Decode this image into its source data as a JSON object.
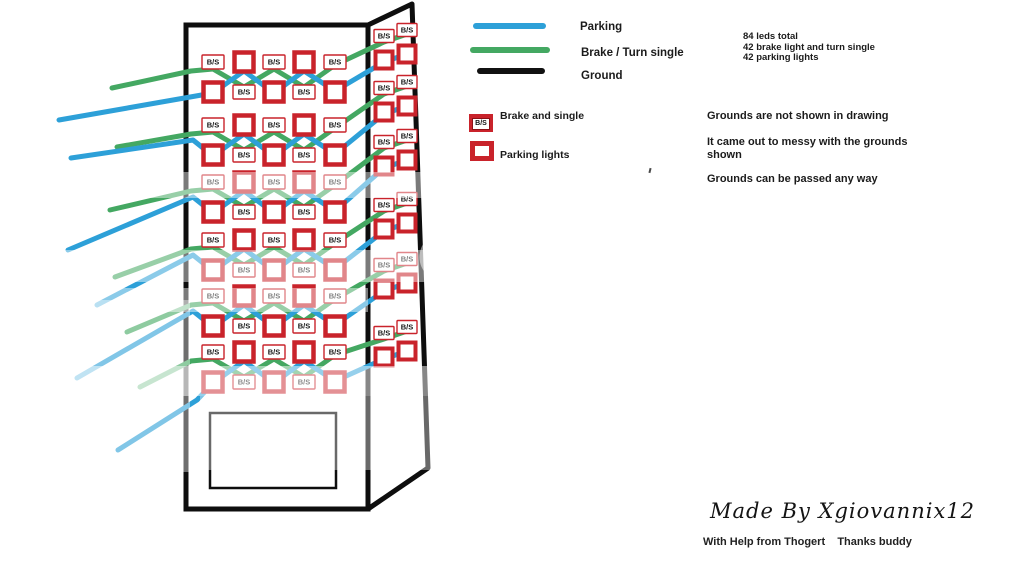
{
  "legend": {
    "lines": [
      {
        "label": "Parking",
        "color": "#2da0d8"
      },
      {
        "label": "Brake / Turn single",
        "color": "#44a862"
      },
      {
        "label": "Ground",
        "color": "#111111"
      }
    ],
    "items": [
      {
        "label": "Brake and single"
      },
      {
        "label": "Parking lights"
      }
    ]
  },
  "stats": [
    "84 leds total",
    "42 brake light and turn single",
    "42 parking lights"
  ],
  "notes": [
    "Grounds are not shown in drawing",
    "It came out to messy with the grounds",
    "shown",
    "Grounds can be passed any way"
  ],
  "credits": {
    "made_by": "Made By Xgiovannix12",
    "help": "With Help from Thogert    Thanks buddy"
  },
  "led_label": "B/S",
  "colors": {
    "wire_parking_blue": "#2da0d8",
    "wire_brake_green": "#44a862",
    "led_red": "#c9232b",
    "outline_black": "#0e0e0e"
  },
  "diagram": {
    "front_cols_x": [
      213,
      244,
      274,
      304,
      335
    ],
    "side_cols_x": [
      384,
      407
    ],
    "row_a_pattern": [
      "bs",
      "p",
      "bs",
      "p",
      "bs"
    ],
    "row_b_pattern": [
      "p",
      "bs",
      "p",
      "bs",
      "p"
    ],
    "groups": [
      {
        "row_a_y": 62,
        "row_b_y": 92,
        "side_y": 36,
        "green_tail": [
          112,
          88
        ],
        "blue_tail": [
          59,
          120
        ],
        "blue_entry": null
      },
      {
        "row_a_y": 125,
        "row_b_y": 155,
        "side_y": 88,
        "green_tail": [
          117,
          147
        ],
        "blue_tail": [
          71,
          158
        ],
        "blue_entry": [
          193,
          140
        ]
      },
      {
        "row_a_y": 182,
        "row_b_y": 212,
        "side_y": 142,
        "green_tail": [
          110,
          210
        ],
        "blue_tail": [
          68,
          250
        ],
        "blue_entry": [
          193,
          197
        ]
      },
      {
        "row_a_y": 240,
        "row_b_y": 270,
        "side_y": 205,
        "green_tail": [
          115,
          277
        ],
        "blue_tail": [
          97,
          305
        ],
        "blue_entry": [
          193,
          255
        ]
      },
      {
        "row_a_y": 296,
        "row_b_y": 326,
        "side_y": 265,
        "green_tail": [
          127,
          332
        ],
        "blue_tail": [
          77,
          378
        ],
        "blue_entry": [
          193,
          311
        ]
      },
      {
        "row_a_y": 352,
        "row_b_y": 382,
        "side_y": 333,
        "green_tail": [
          140,
          387
        ],
        "blue_tail": [
          118,
          450
        ],
        "blue_entry": [
          197,
          400
        ]
      }
    ]
  }
}
